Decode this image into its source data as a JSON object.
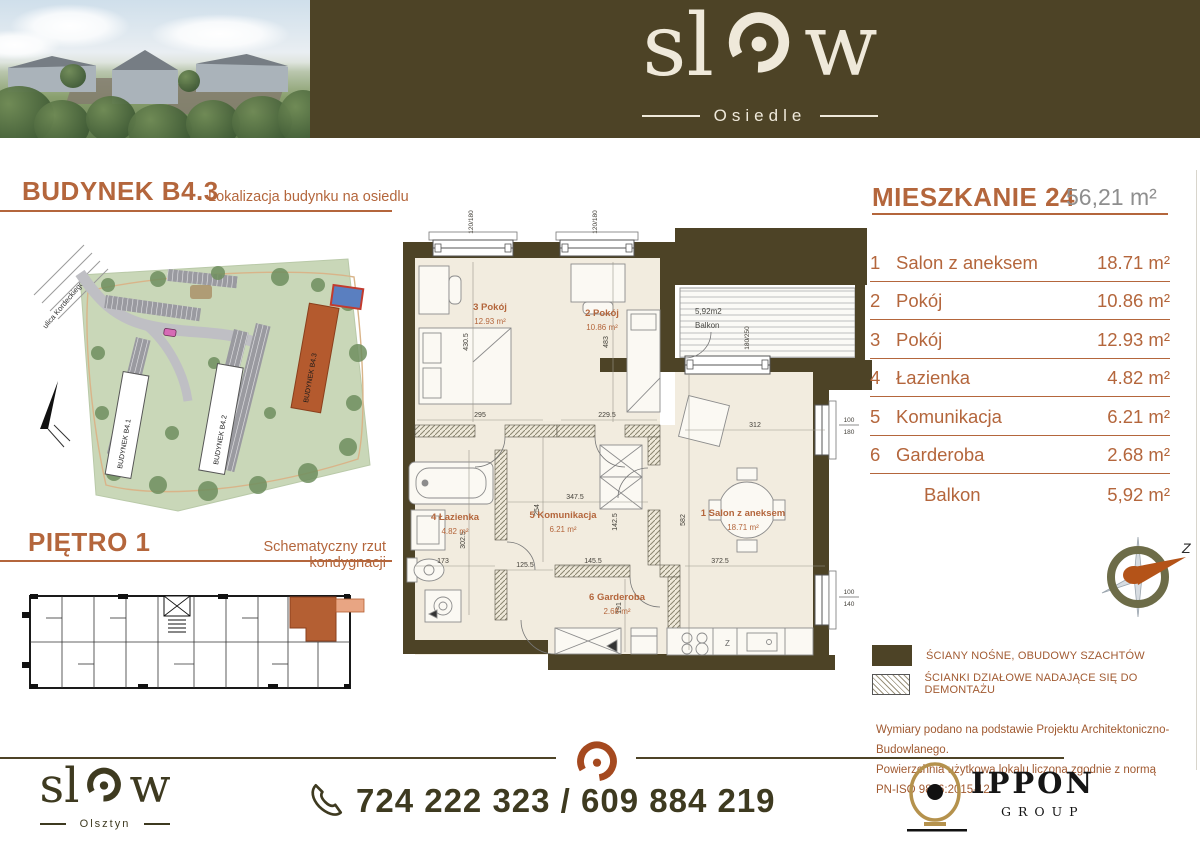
{
  "colors": {
    "olive": "#4d4326",
    "rust": "#b4663c",
    "cream": "#f2ecdf",
    "gold": "#b5924d"
  },
  "header": {
    "brand": {
      "pre": "sl",
      "post": "w",
      "subtitle": "Osiedle"
    }
  },
  "left": {
    "building_title": "BUDYNEK B4.3",
    "building_subtitle": "Lokalizacja budynku na osiedlu",
    "floor_title": "PIĘTRO 1",
    "floor_subtitle": "Schematyczny rzut kondygnacji",
    "map": {
      "street": "ulica Kordeckiego",
      "b1": "BUDYNEK B4.1",
      "b2": "BUDYNEK B4.2",
      "b3": "BUDYNEK B4.3"
    }
  },
  "apartment": {
    "title": "MIESZKANIE 24",
    "total_area": "56,21 m²",
    "rooms": [
      {
        "num": "1",
        "name": "Salon z aneksem",
        "area": "18.71 m²"
      },
      {
        "num": "2",
        "name": "Pokój",
        "area": "10.86 m²"
      },
      {
        "num": "3",
        "name": "Pokój",
        "area": "12.93 m²"
      },
      {
        "num": "4",
        "name": "Łazienka",
        "area": "4.82 m²"
      },
      {
        "num": "5",
        "name": "Komunikacja",
        "area": "6.21 m²"
      },
      {
        "num": "6",
        "name": "Garderoba",
        "area": "2.68 m²"
      },
      {
        "num": "",
        "name": "Balkon",
        "area": "5,92 m²"
      }
    ]
  },
  "floorplan": {
    "rooms": {
      "salon": {
        "title": "1  Salon z aneksem",
        "area": "18.71 m²"
      },
      "pokoj2": {
        "title": "2  Pokój",
        "area": "10.86 m²"
      },
      "pokoj3": {
        "title": "3  Pokój",
        "area": "12.93 m²"
      },
      "lazienka": {
        "title": "4  Łazienka",
        "area": "4.82 m²"
      },
      "komunikacja": {
        "title": "5  Komunikacja",
        "area": "6.21 m²"
      },
      "garderoba": {
        "title": "6  Garderoba",
        "area": "2.68 m²"
      }
    },
    "balcony": {
      "area": "5,92m2",
      "label": "Balkon"
    },
    "dims": {
      "room3_h": "430.5",
      "room3_w": "295",
      "room2_h": "483",
      "room2_w": "229.5",
      "salon_top_w": "312",
      "salon_w": "372.5",
      "salon_h": "582",
      "hall_top_w": "347.5",
      "bath_h": "302.5",
      "hall_h": "254",
      "hall_w": "125.5",
      "ward_top_w": "145.5",
      "ward_right_h": "142.5",
      "ward_h": "191",
      "bath_w": "173"
    },
    "windows": {
      "top1": "120/180",
      "top2": "120/180",
      "balcony_door": "180/250",
      "right_w": "100",
      "right_h": "180",
      "bottom_w": "100",
      "bottom_h": "140"
    },
    "kitchen_sink": "Z"
  },
  "legend": {
    "items": [
      {
        "label": "ŚCIANY NOŚNE, OBUDOWY SZACHTÓW"
      },
      {
        "label": "ŚCIANKI DZIAŁOWE NADAJĄCE SIĘ DO DEMONTAŻU"
      }
    ],
    "compass": "Z"
  },
  "disclaimer": {
    "line1": "Wymiary podano na podstawie Projektu Architektoniczno-Budowlanego.",
    "line2": "Powierzchnia użytkowa lokalu liczona zgodnie z normą PN-ISO 9836:2015-12."
  },
  "footer": {
    "brand": {
      "pre": "sl",
      "post": "w",
      "subtitle": "Olsztyn"
    },
    "phone": "724 222 323 / 609 884 219",
    "partner": {
      "name": "IPPON",
      "sub": "GROUP"
    }
  }
}
